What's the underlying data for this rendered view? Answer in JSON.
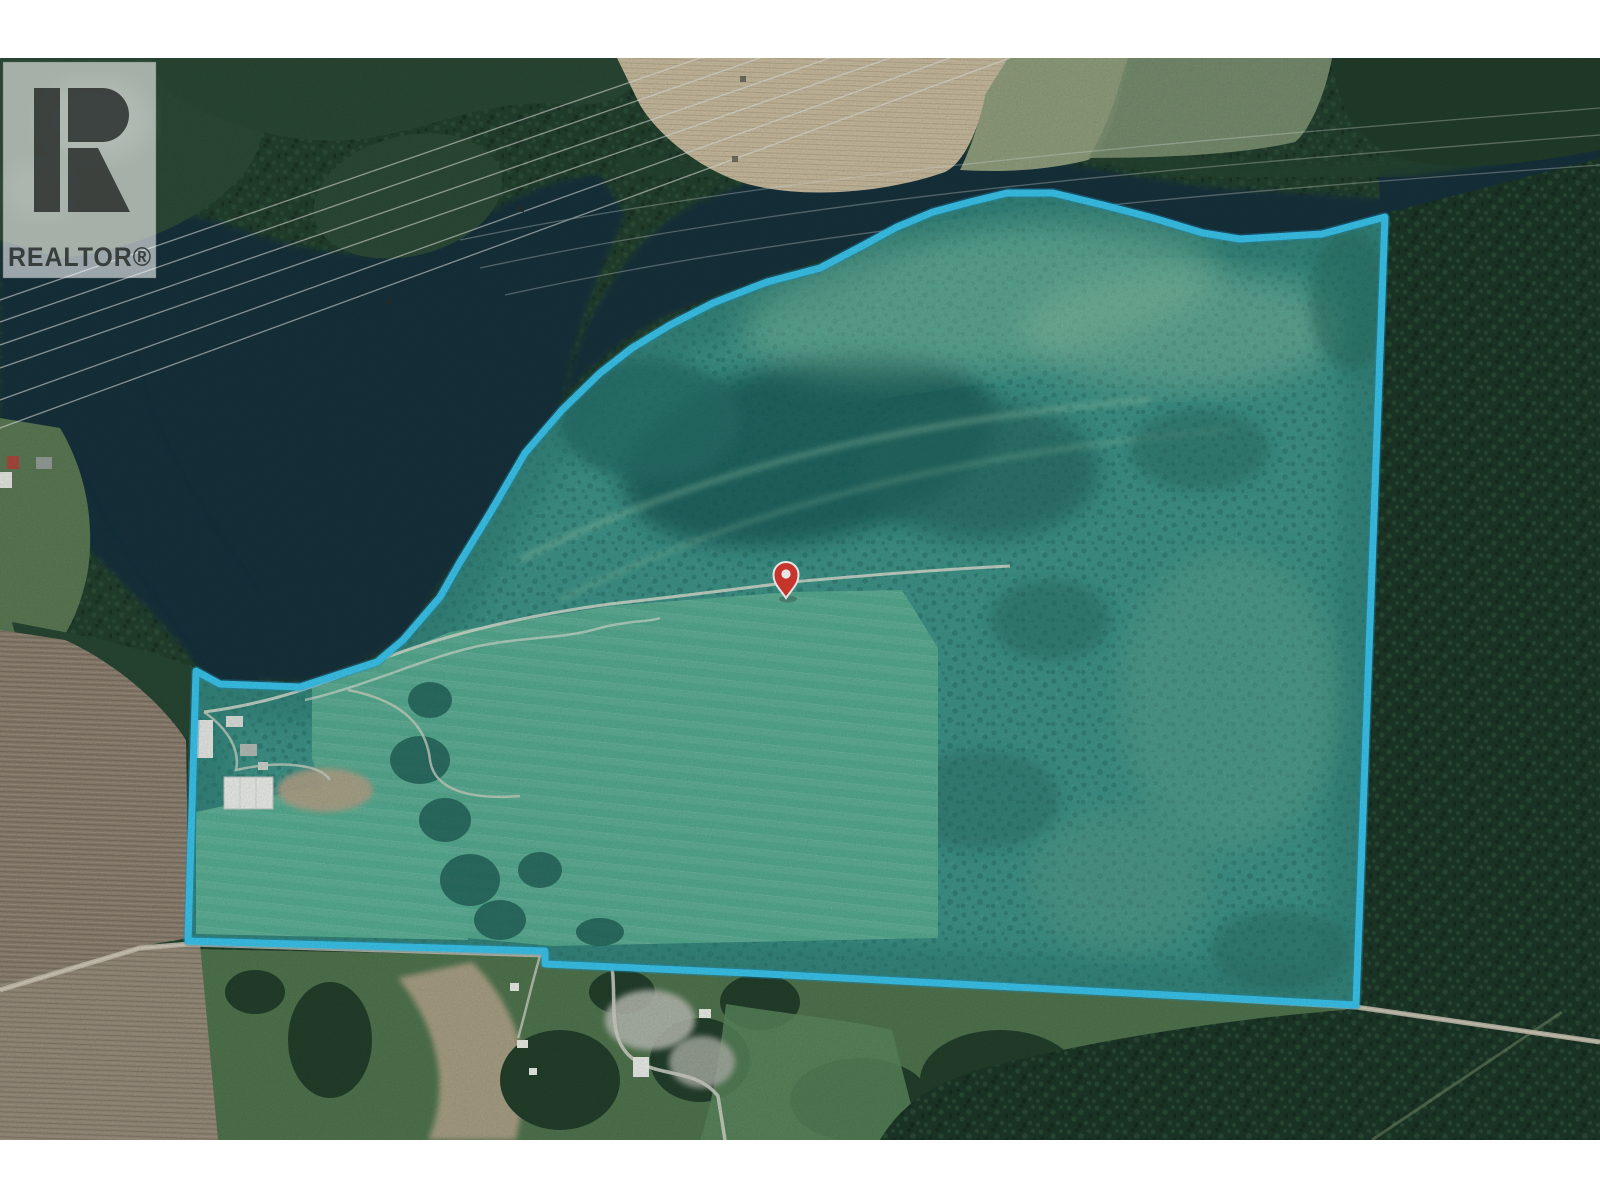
{
  "watermark": {
    "brand_label": "REALTOR®"
  },
  "map": {
    "type": "aerial-satellite-photo-with-property-outline",
    "boundary_color": "#3bc7ef",
    "boundary_points": "196,671 220,684 300,687 377,662 403,640 440,597 460,562 490,513 525,453 562,410 600,373 632,348 670,325 713,303 767,282 820,268 860,247 897,227 933,212 970,202 1007,193 1053,193 1103,205 1153,218 1203,233 1240,239 1322,234 1385,217 1356,1005 747,973 545,964 545,951 188,941",
    "pin": {
      "x": 786,
      "y": 580,
      "transform": "translate(786,580)",
      "color": "#dc3b30"
    }
  }
}
